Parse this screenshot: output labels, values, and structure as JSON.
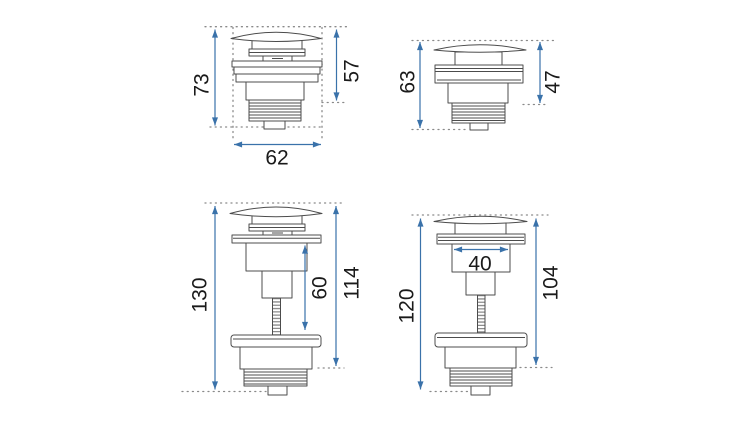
{
  "palette": {
    "background": "#ffffff",
    "outline": "#4c4c4c",
    "dotted_guides": "#8a8a8a",
    "dimension_blue": "#3a72aa",
    "label_text": "#1a1a1a"
  },
  "figure": {
    "views": [
      {
        "id": "top-left",
        "dimensions": {
          "total_height": "73",
          "upper_height": "57",
          "width": "62"
        }
      },
      {
        "id": "top-right",
        "dimensions": {
          "total_height": "63",
          "upper_height": "47"
        }
      },
      {
        "id": "bottom-left",
        "dimensions": {
          "total_height": "130",
          "stem_section": "60",
          "body_height": "114"
        }
      },
      {
        "id": "bottom-right",
        "dimensions": {
          "total_height": "120",
          "cap_width": "40",
          "body_height": "104"
        }
      }
    ]
  }
}
